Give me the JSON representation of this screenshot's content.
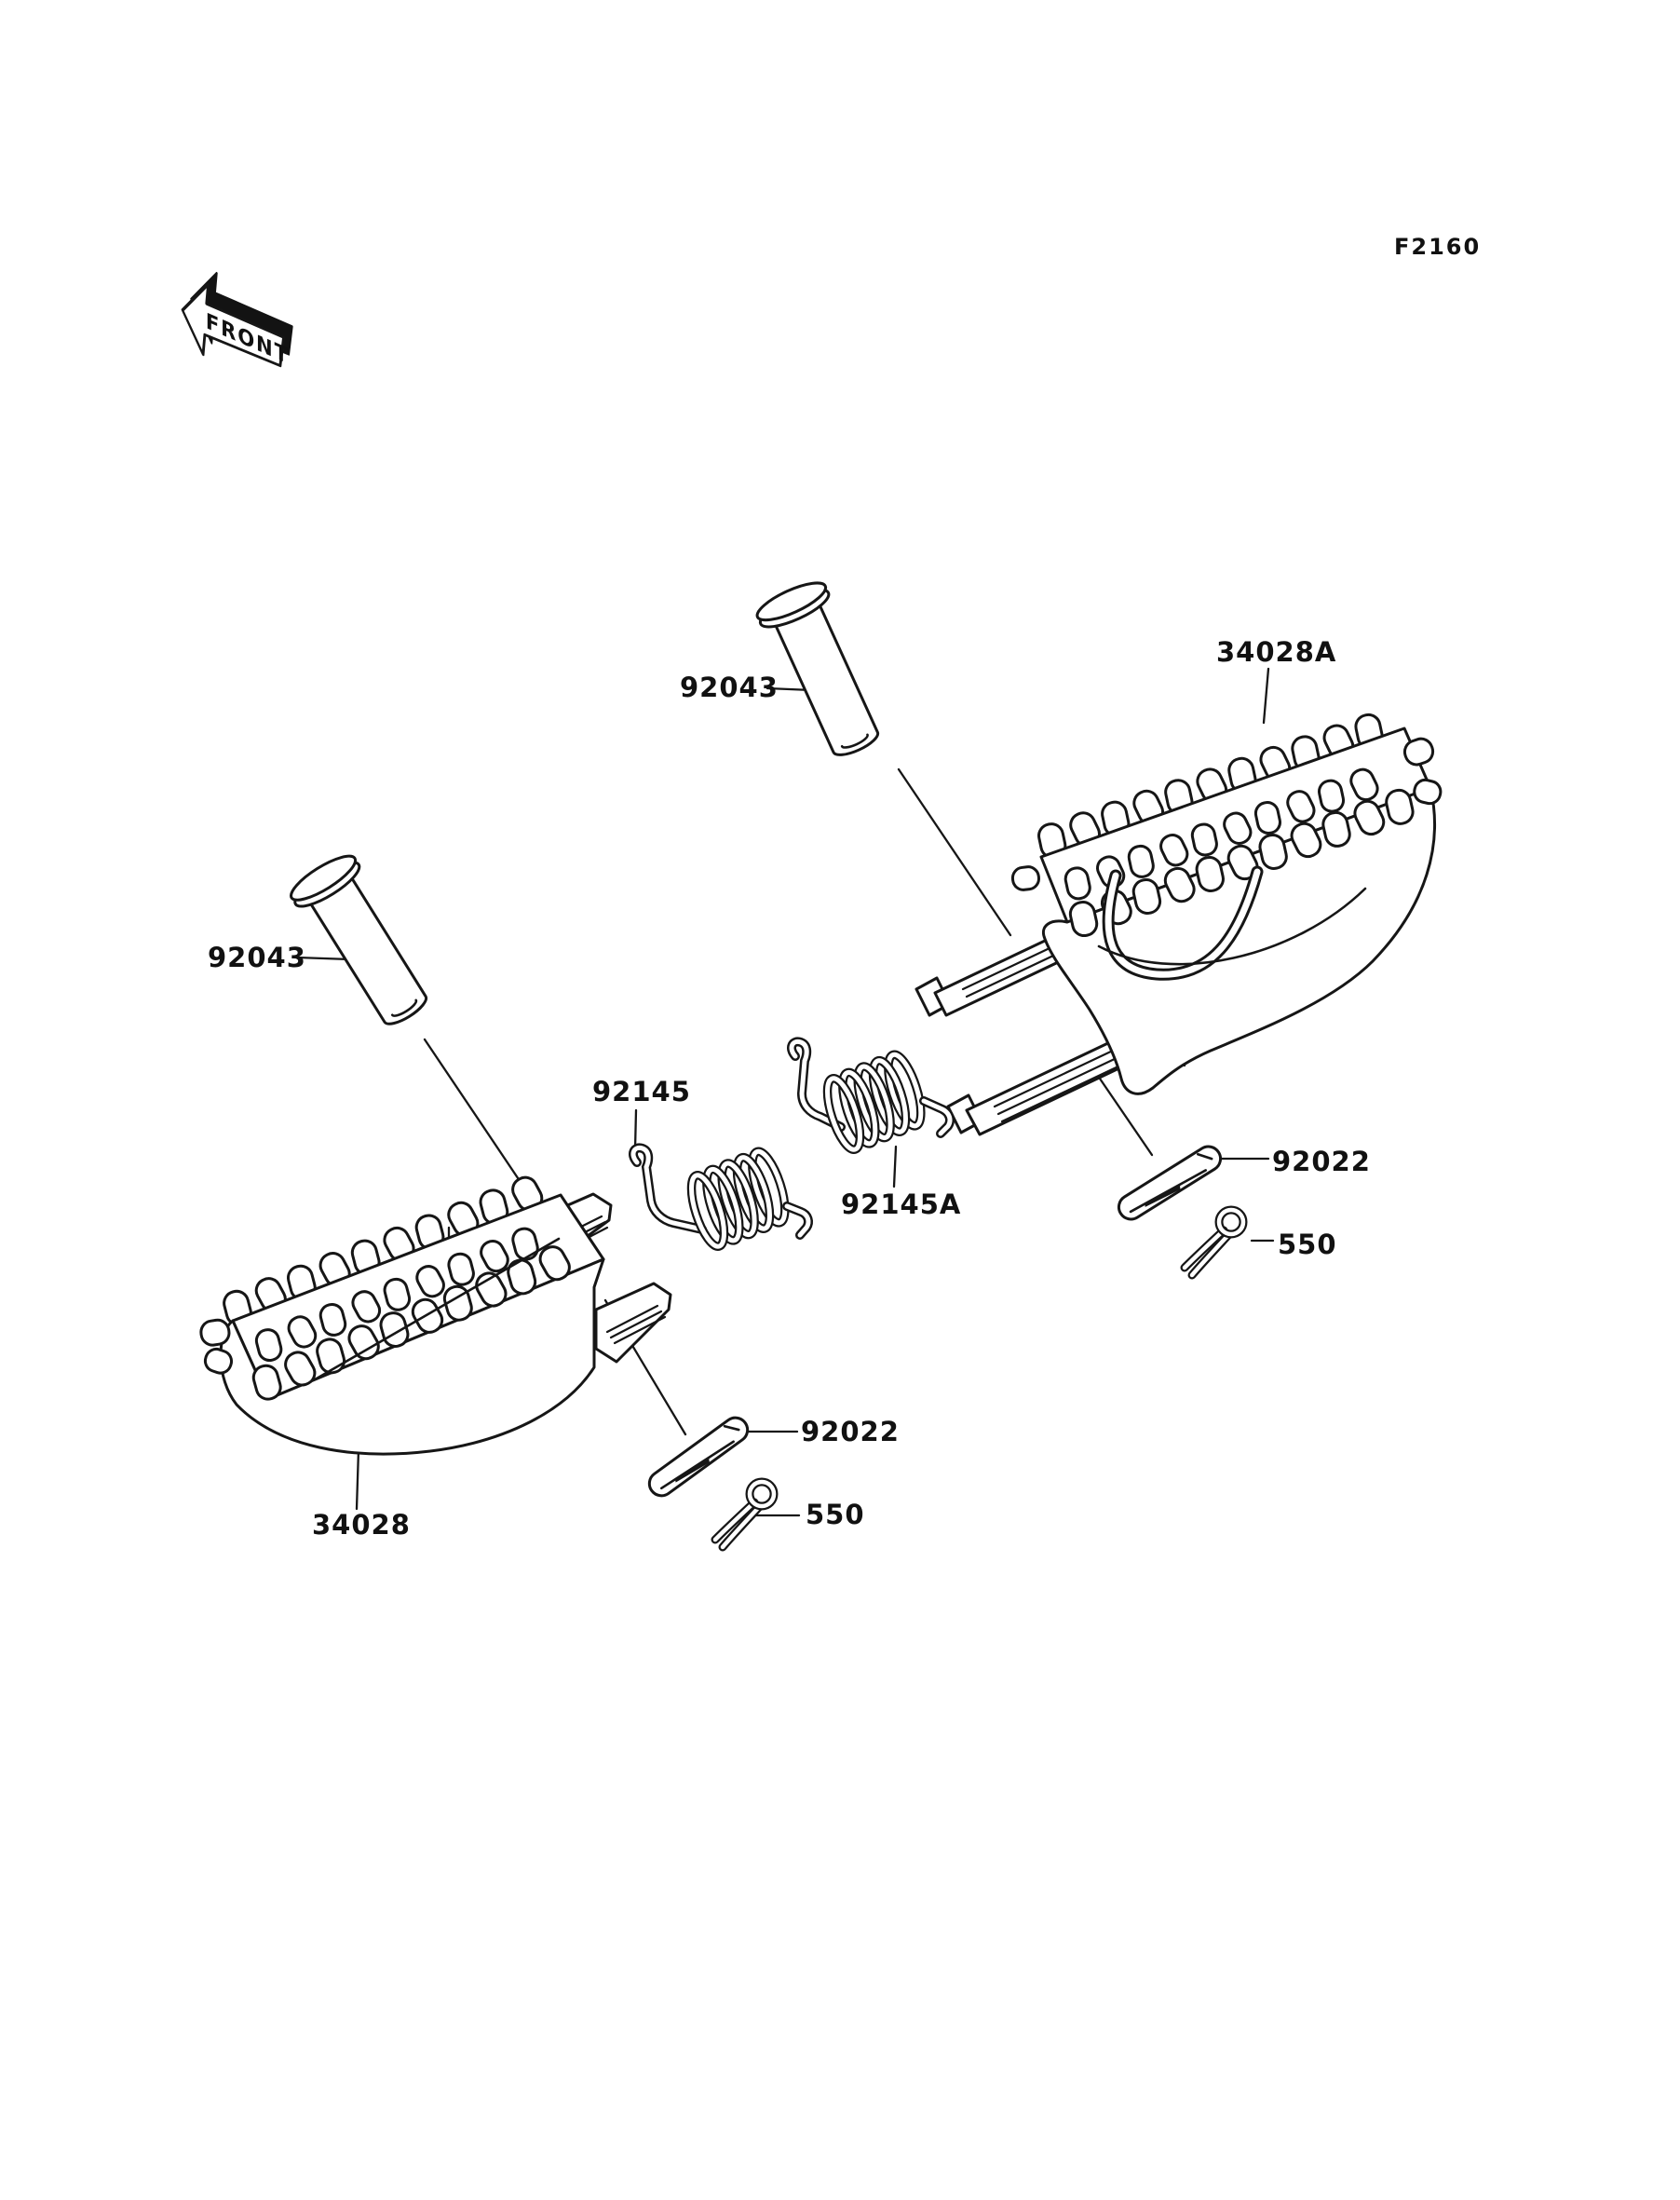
{
  "figure": {
    "code": "F2160",
    "front_marker": "FRONT"
  },
  "colors": {
    "line": "#161616",
    "background": "#ffffff"
  },
  "parts": {
    "footpeg_upper": {
      "number": "34028A"
    },
    "footpeg_lower": {
      "number": "34028"
    },
    "pin_upper": {
      "number": "92043"
    },
    "pin_lower": {
      "number": "92043"
    },
    "spring_lower": {
      "number": "92145"
    },
    "spring_upper": {
      "number": "92145A"
    },
    "washer_upper": {
      "number": "92022"
    },
    "washer_lower": {
      "number": "92022"
    },
    "cotter_pin_upper": {
      "number": "550"
    },
    "cotter_pin_lower": {
      "number": "550"
    }
  }
}
